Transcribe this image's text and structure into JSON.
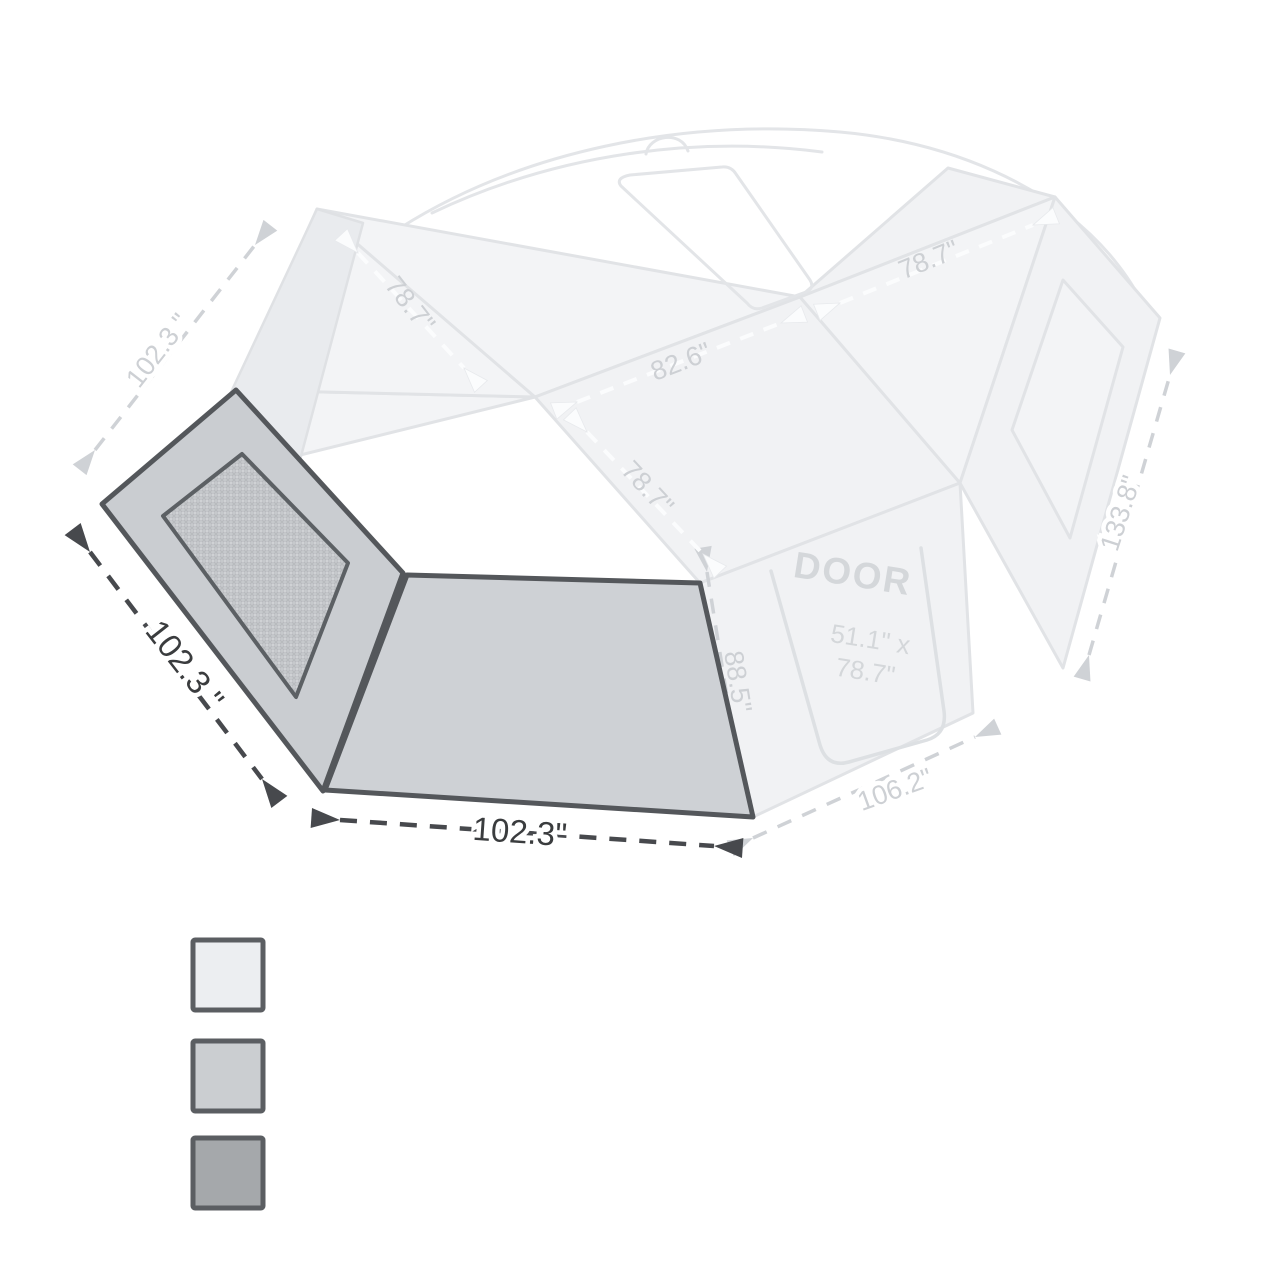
{
  "diagram_type": "awning-wall-dimension-diagram",
  "dimensions": {
    "roof_left_edge": "102.3 \"",
    "roof_rafter_left": "78.7\"",
    "roof_ridge": "82.6\"",
    "roof_rafter_front": "78.7\"",
    "roof_right_edge": "78.7\"",
    "side_wall_diagonal": "133.8\"",
    "door_wall_height": "88.5\"",
    "door_wall_bottom": "106.2\"",
    "left_wall_slant_edge": "102.3 \"",
    "front_wall_bottom": "102.3\""
  },
  "door": {
    "label": "DOOR",
    "size_line1": "51.1\" x",
    "size_line2": "78.7\""
  },
  "colors": {
    "background": "#ffffff",
    "faded_line": "#e1e3e6",
    "faded_fill": "#f3f4f6",
    "faded_label": "#cdd0d4",
    "dark_dim_line": "#47494d",
    "dark_dim_label": "#3a3c3e",
    "panel_outline": "#54575b",
    "left_wall_fill": "#cacdd1",
    "front_wall_fill": "#ced1d5",
    "mesh_fill": "#c6c9cc",
    "swatch_border": "#5b5e62"
  },
  "legend": {
    "swatches": [
      {
        "name": "roof-fabric-light",
        "color": "#eceef1"
      },
      {
        "name": "wall-fabric-medium",
        "color": "#cbced1"
      },
      {
        "name": "mesh-fabric-dark",
        "color": "#a5a8ab"
      }
    ]
  }
}
